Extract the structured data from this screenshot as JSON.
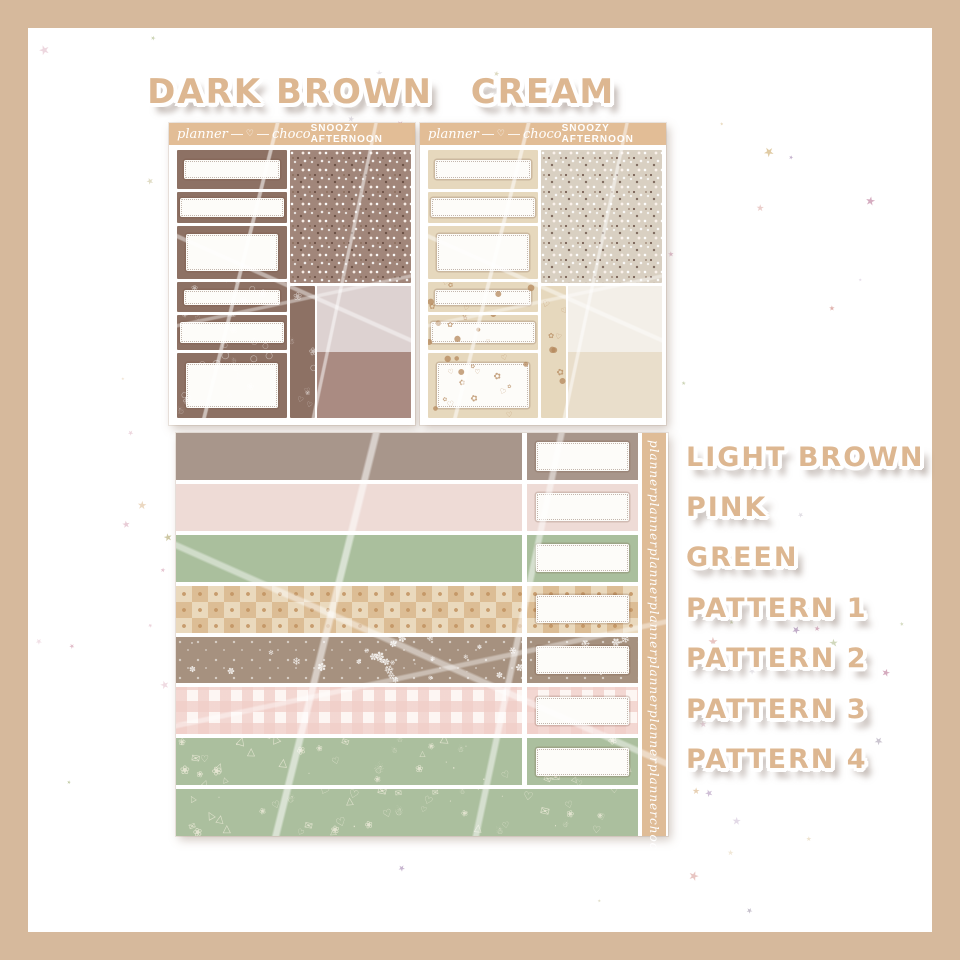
{
  "colors": {
    "border": "#d6b99c",
    "background": "#ffffff",
    "label_text": "#ddb791",
    "header_bg": "#e2bd96",
    "header_text": "#ffffff",
    "vertical_strip_bg": "#dfbc97",
    "torn_sticker": "#fdfcf9"
  },
  "star_colors": [
    "#dcaebe",
    "#c387a3",
    "#a98cb5",
    "#a2b077",
    "#bcb482",
    "#d8bd8c",
    "#e2c5a2",
    "#b7afbe",
    "#d79a94"
  ],
  "title_labels": {
    "dark_brown": "DARK BROWN",
    "cream": "CREAM"
  },
  "sheets": [
    {
      "name": "dark-brown",
      "brand_left": "planner",
      "brand_heart": "♡",
      "brand_right": "choco",
      "collection": "SNOOZY AFTERNOON",
      "box_color": "#8d7164",
      "glitter_base": "#a1867a",
      "swatch_top": "#ddd2d1",
      "swatch_bottom": "#aa8b82",
      "doodle_glyphs": [
        "♡",
        "❀",
        "☃",
        "○"
      ],
      "doodle_ink": "#ffffff",
      "doodle_opacity": 0.5,
      "doodle_min": 6,
      "doodle_max": 11
    },
    {
      "name": "cream",
      "brand_left": "planner",
      "brand_heart": "♡",
      "brand_right": "choco",
      "collection": "SNOOZY AFTERNOON",
      "box_color": "#e6d8bd",
      "glitter_base": "#d9d0c2",
      "swatch_top": "#f3efe8",
      "swatch_bottom": "#e9decb",
      "doodle_glyphs": [
        "✿",
        "●",
        "♡"
      ],
      "doodle_ink": "#b5885c",
      "doodle_opacity": 0.75,
      "doodle_min": 5,
      "doodle_max": 9
    }
  ],
  "washi": {
    "vertical_text": [
      "planner",
      "planner",
      "planner",
      "planner",
      "planner",
      "planner",
      "planner",
      "choco"
    ],
    "snow_glyphs": [
      "❄",
      "✽",
      "·"
    ],
    "snow_ink": "#ffffff",
    "doodle_glyphs": [
      "☃",
      "♡",
      "✉",
      "❀",
      "△",
      "·"
    ],
    "doodle_ink": "#ecead8",
    "strips": [
      {
        "label": "LIGHT BROWN",
        "pattern": "solid",
        "color": "#a8968b"
      },
      {
        "label": "PINK",
        "pattern": "solid",
        "color": "#eedbd6"
      },
      {
        "label": "GREEN",
        "pattern": "solid",
        "color": "#aabf9d"
      },
      {
        "label": "PATTERN 1",
        "pattern": "checker",
        "color": "#ead9bd",
        "accent": "#dcbd95"
      },
      {
        "label": "PATTERN 2",
        "pattern": "snowflake",
        "color": "#a6917f",
        "accent": "#ffffff"
      },
      {
        "label": "PATTERN 3",
        "pattern": "gingham",
        "color": "#fdf6f3",
        "accent": "#f0cdc7"
      },
      {
        "label": "PATTERN 4",
        "pattern": "doodle-green",
        "color": "#abbf9e",
        "accent": "#ecead8"
      },
      {
        "label": "",
        "pattern": "doodle-green",
        "color": "#abbf9e",
        "accent": "#ecead8",
        "full_width": true
      }
    ]
  },
  "side_labels": [
    "LIGHT BROWN",
    "PINK",
    "GREEN",
    "PATTERN 1",
    "PATTERN 2",
    "PATTERN 3",
    "PATTERN 4"
  ]
}
